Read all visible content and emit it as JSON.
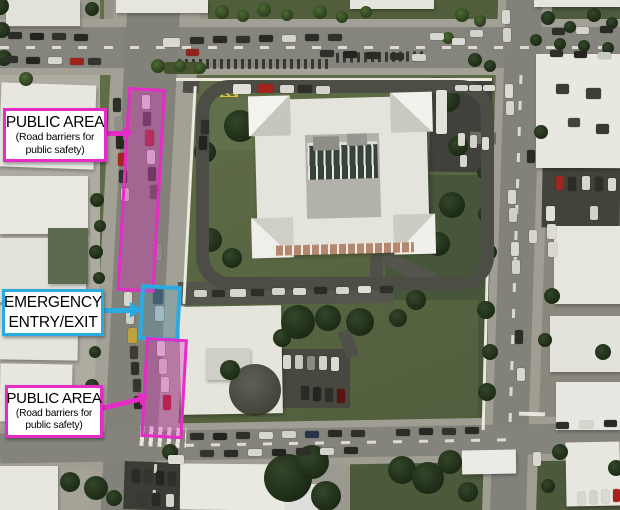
{
  "title": "Aerial site map with public-safety annotations",
  "colors": {
    "public_area": "#e52cc6",
    "public_area_fill": "rgba(229,44,198,0.33)",
    "emergency": "#29abe2",
    "emergency_fill": "rgba(41,171,226,0.17)",
    "label_background": "#ffffff",
    "label_text": "#000000"
  },
  "callouts": {
    "public_area_top": {
      "title": "PUBLIC AREA",
      "sub1": "(Road barriers for",
      "sub2": "public safety)"
    },
    "emergency": {
      "line1": "EMERGENCY",
      "line2": "ENTRY/EXIT"
    },
    "public_area_bottom": {
      "title": "PUBLIC AREA",
      "sub1": "(Road barriers for",
      "sub2": "public safety)"
    }
  }
}
